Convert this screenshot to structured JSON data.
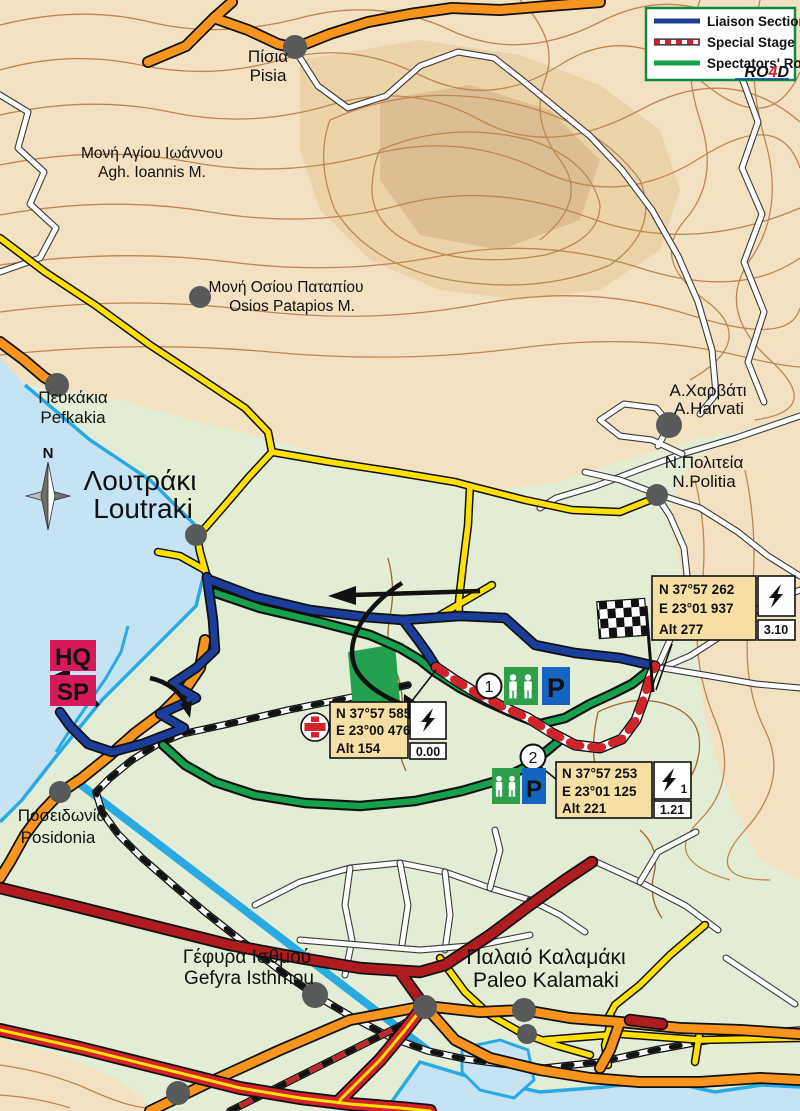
{
  "legend": {
    "items": [
      {
        "label": "Liaison Section",
        "color": "#1B3F94",
        "style": "solid"
      },
      {
        "label": "Special Stage",
        "color": "#D2232A",
        "style": "red-white-dashed"
      },
      {
        "label": "Spectators' Route",
        "color": "#17A14E",
        "style": "solid"
      }
    ],
    "logo_parts": {
      "p1": "RO",
      "p2": "4",
      "p3": "D"
    }
  },
  "colors": {
    "liaison": "#1C3E9B",
    "special_stage": "#D2232A",
    "spectators_route": "#17A14E",
    "hq_sp_badge": "#D6195B",
    "parking_sign": "#1565C0",
    "spectator_area_sign": "#2E9E49",
    "sea": "#C5E3F3",
    "lowland": "#E3ECD4",
    "upland": "#F2E2C2"
  },
  "places": {
    "pisia": {
      "gr": "Πίσια",
      "en": "Pisia"
    },
    "agh_ioannis": {
      "gr": "Μονή Αγίου Ιωάννου",
      "en": "Agh. Ioannis M."
    },
    "osios_patapios": {
      "gr": "Μονή Οσίου Παταπίου",
      "en": "Osios Patapios M."
    },
    "pefkakia": {
      "gr": "Πευκάκια",
      "en": "Pefkakia"
    },
    "loutraki": {
      "gr": "Λουτράκι",
      "en": "Loutraki"
    },
    "harvati": {
      "gr": "Α.Χαρβάτι",
      "en": "A.Harvati"
    },
    "npolitia": {
      "gr": "Ν.Πολιτεία",
      "en": "N.Politia"
    },
    "posidonia": {
      "gr": "Ποσειδωνία",
      "en": "Posidonia"
    },
    "gefyra": {
      "gr": "Γέφυρα Ισθμού",
      "en": "Gefyra Isthmou"
    },
    "kalamaki": {
      "gr": "Παλαιό Καλαμάκι",
      "en": "Paleo Kalamaki"
    }
  },
  "badges": {
    "hq": "HQ",
    "sp": "SP"
  },
  "compass": {
    "north": "N"
  },
  "waypoints": {
    "start": {
      "lat": "N 37°57 585",
      "lon": "E 23°00 476",
      "alt": "Alt 154",
      "km": "0.00"
    },
    "radio": {
      "lat": "N 37°57 253",
      "lon": "E 23°01 125",
      "alt": "Alt 221",
      "km": "1.21",
      "radio_number": "1"
    },
    "finish": {
      "lat": "N 37°57 262",
      "lon": "E 23°01 937",
      "alt": "Alt 277",
      "km": "3.10"
    }
  },
  "spectator_points": [
    {
      "number": "1",
      "parking": "P"
    },
    {
      "number": "2",
      "parking": "P"
    }
  ]
}
